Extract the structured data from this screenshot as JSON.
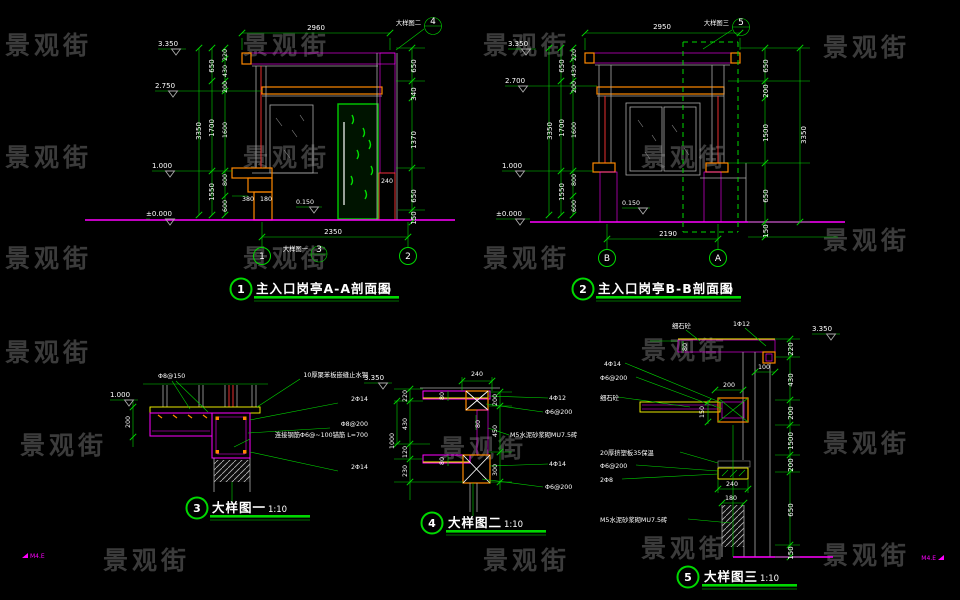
{
  "watermark_text": "景观街",
  "corner_mark": "M4.E",
  "d1": {
    "title_num": "1",
    "title": "主入口岗亭A-A剖面图",
    "scale": "1:30",
    "dim_top": "2960",
    "callout_label": "大样图二",
    "callout_num": "4",
    "ref_label": "大样图一",
    "ref_num": "3",
    "levels": [
      "3.350",
      "2.750",
      "1.000",
      "±0.000"
    ],
    "floor_level": "0.150",
    "left_outer": "3350",
    "left_mid": [
      "650",
      "1700",
      "1550"
    ],
    "left_inner": [
      "220",
      "430",
      "200",
      "1600",
      "800",
      "600"
    ],
    "right_chain": [
      "650",
      "340",
      "1370",
      "650",
      "150"
    ],
    "col_width": "240",
    "ledge_dims": [
      "380",
      "180"
    ],
    "dim_bottom": "2350",
    "axis_left": "1",
    "axis_right": "2"
  },
  "d2": {
    "title_num": "2",
    "title": "主入口岗亭B-B剖面图",
    "scale": "1:30",
    "dim_top": "2950",
    "callout_label": "大样图三",
    "callout_num": "5",
    "levels": [
      "3.350",
      "2.700",
      "1.000",
      "±0.000"
    ],
    "floor_level": "0.150",
    "left_outer": "3350",
    "left_mid": [
      "650",
      "1700",
      "1550"
    ],
    "left_inner": [
      "220",
      "430",
      "200",
      "1600",
      "800",
      "600"
    ],
    "right_chain": [
      "650",
      "200",
      "1500",
      "650",
      "150"
    ],
    "right_outer": "3350",
    "dim_bottom": "2190",
    "axis_left": "B",
    "axis_right": "A"
  },
  "d3": {
    "title_num": "3",
    "title": "大样图一",
    "scale": "1:10",
    "level": "1.000",
    "dim_height": "200",
    "top_label": "Φ8@150",
    "labels": [
      "10厚聚苯板嵌缝止水钢",
      "2Φ14",
      "Φ8@200",
      "连接钢筋Φ6@~100锚筋 L=700",
      "2Φ14"
    ]
  },
  "d4": {
    "title_num": "4",
    "title": "大样图二",
    "scale": "1:10",
    "level": "3.350",
    "dim_top": "240",
    "left_outer": "1000",
    "left_chain": [
      "220",
      "430",
      "120",
      "230"
    ],
    "right_chain": [
      "200",
      "450",
      "300"
    ],
    "inner_dims": [
      "80",
      "80",
      "80"
    ],
    "labels": [
      "4Φ12",
      "Φ6@200",
      "M5水泥砂浆砌MU7.5砖",
      "4Φ14",
      "Φ6@200"
    ]
  },
  "d5": {
    "title_num": "5",
    "title": "大样图三",
    "scale": "1:10",
    "level": "3.350",
    "top_labels": [
      "细石砼",
      "1Φ12"
    ],
    "left_labels": [
      "4Φ14",
      "Φ6@200",
      "细石砼",
      "20厚挤塑板35保温",
      "Φ6@200",
      "2Φ8",
      "M5水泥砂浆砌MU7.5砖"
    ],
    "right_chain": [
      "220",
      "430",
      "200",
      "1500",
      "200",
      "650",
      "150"
    ],
    "dim_80": "80",
    "dim_100": "100",
    "dim_200": "200",
    "dim_150": "150",
    "dim_240": "240",
    "dim_180": "180"
  }
}
